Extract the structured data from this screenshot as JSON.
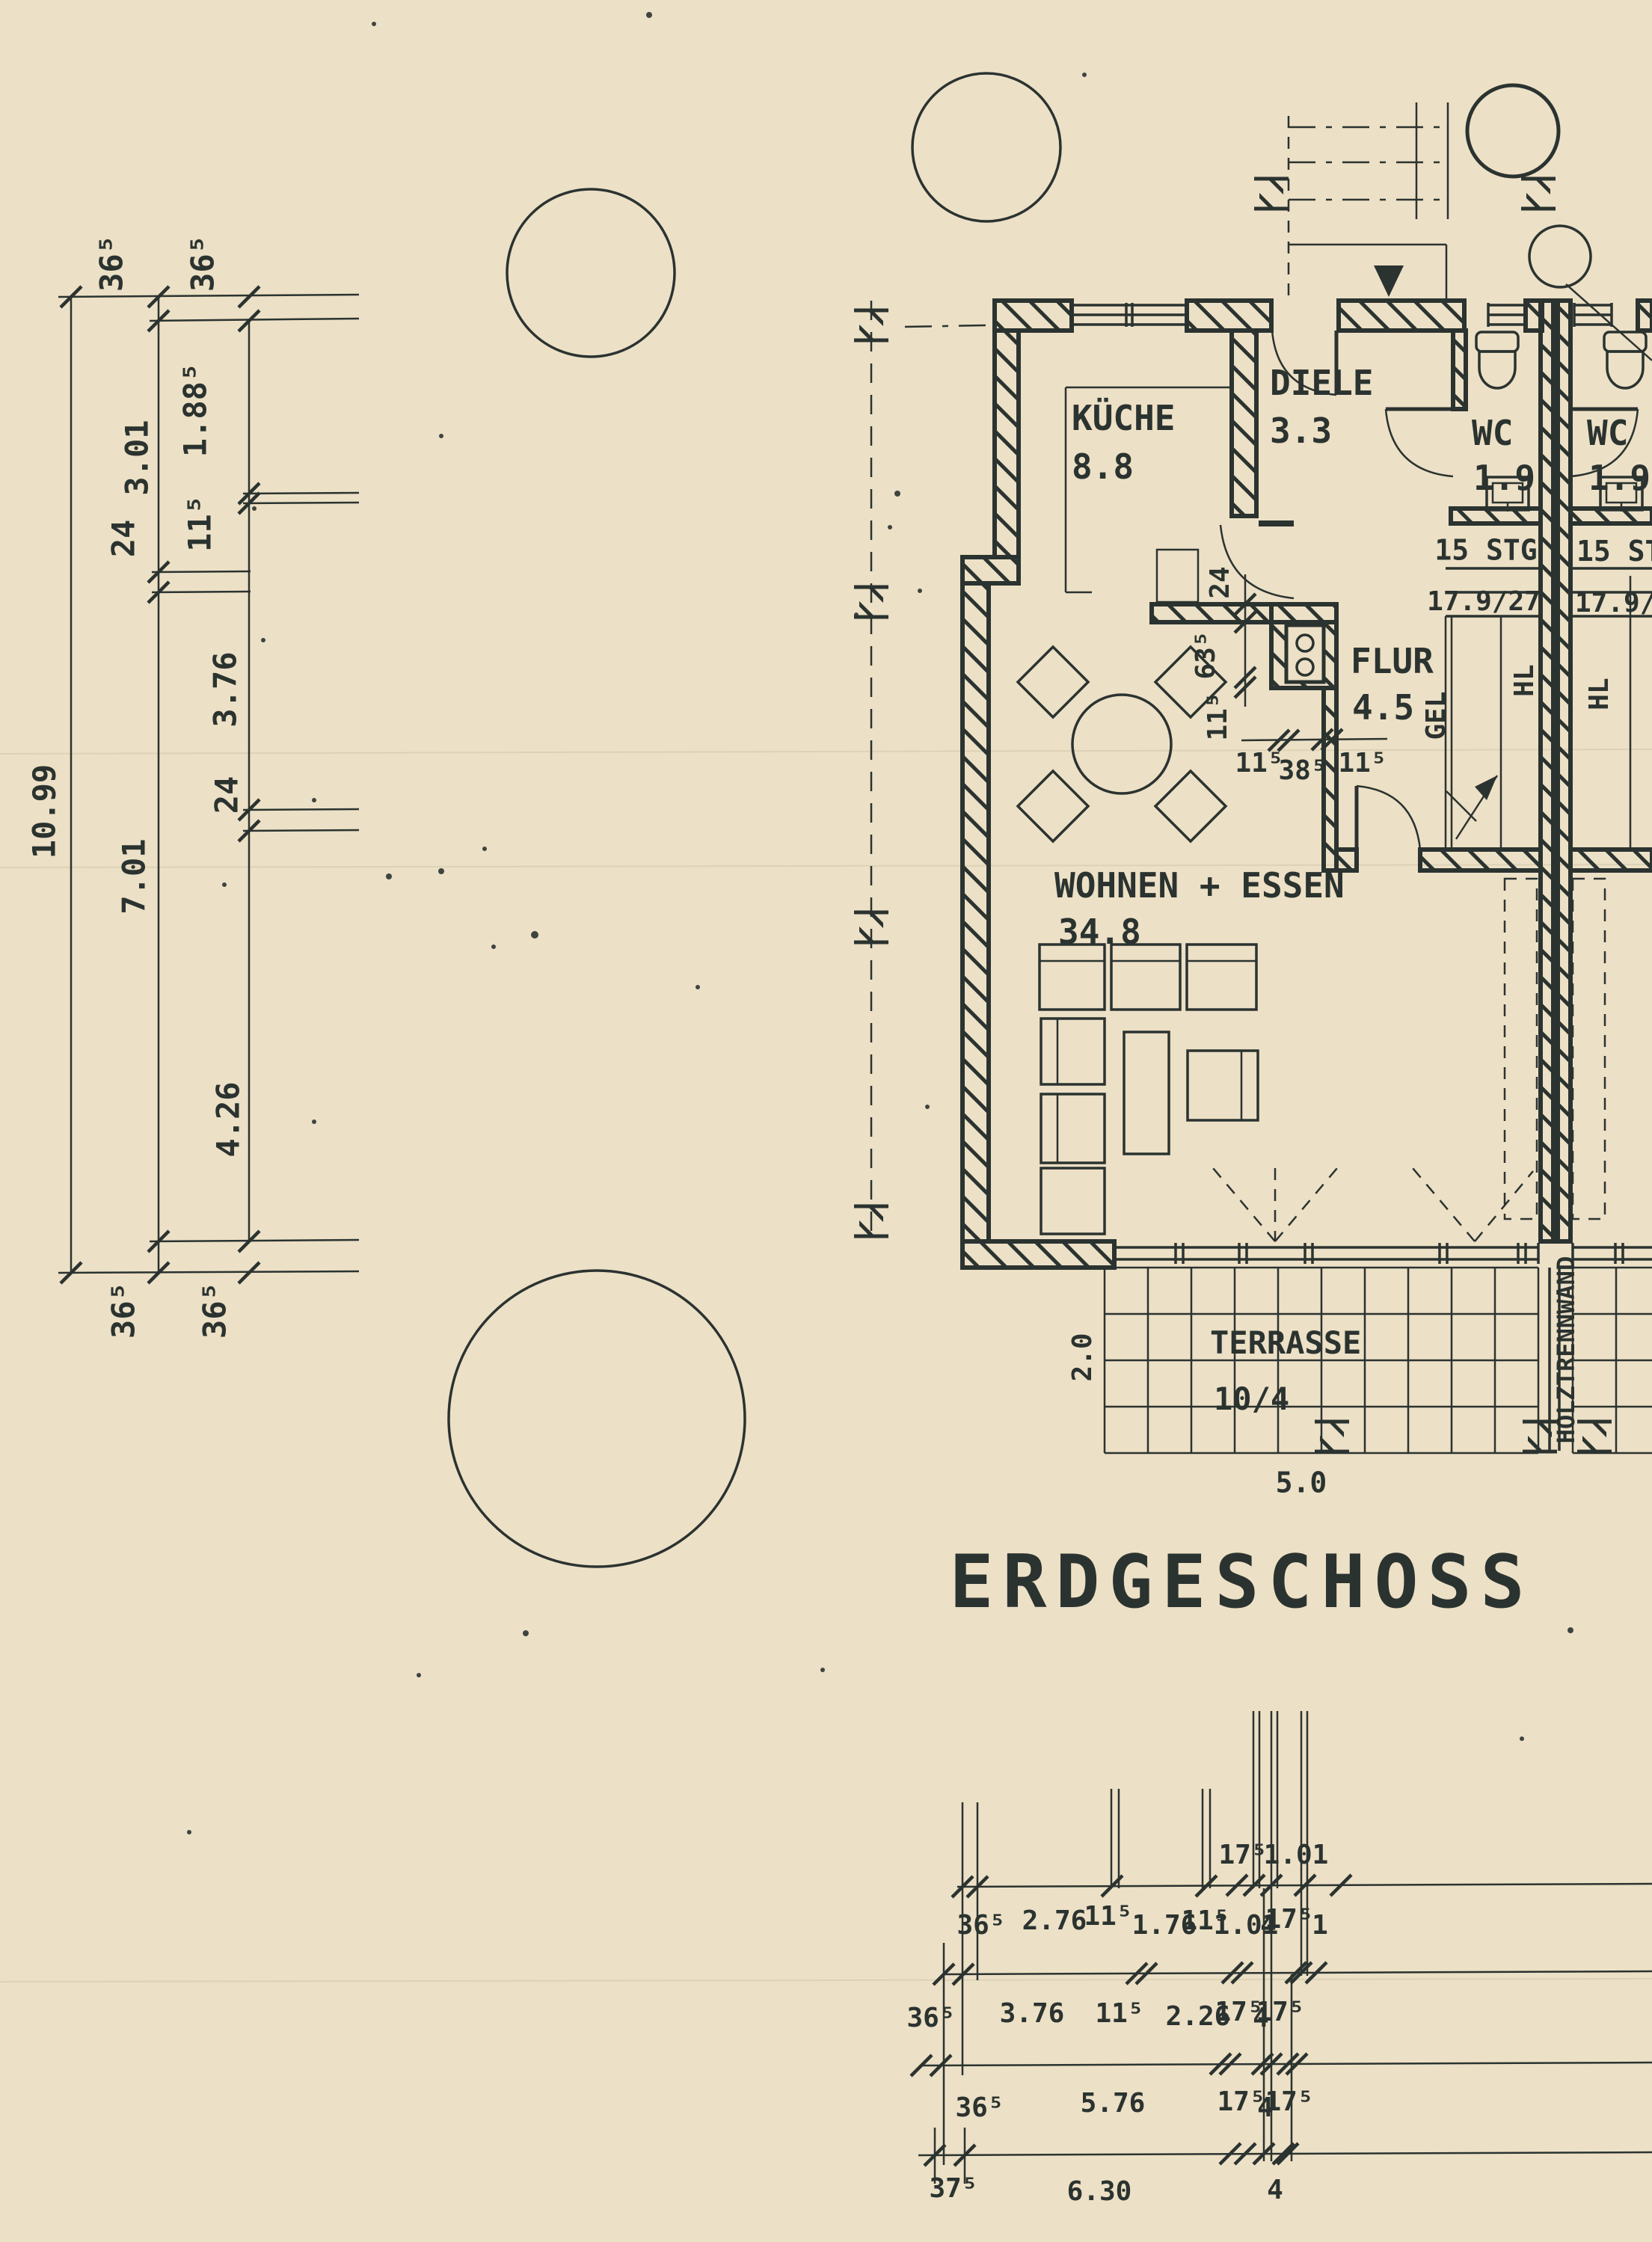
{
  "colors": {
    "paper": "#ece0c6",
    "ink": "#2b3330"
  },
  "title": "ERDGESCHOSS",
  "rooms": {
    "kueche": {
      "name": "KÜCHE",
      "area": "8.8"
    },
    "diele": {
      "name": "DIELE",
      "area": "3.3"
    },
    "wc_left": {
      "name": "WC",
      "area": "1.9"
    },
    "wc_right": {
      "name": "WC",
      "area": "1.9"
    },
    "flur": {
      "name": "FLUR",
      "area": "4.5"
    },
    "wohnen": {
      "name": "WOHNEN + ESSEN",
      "area": "34.8"
    },
    "terrasse": {
      "name": "TERRASSE",
      "area": "10/4"
    }
  },
  "stairs": {
    "left": {
      "steps": "15 STG",
      "ratio": "17.9/27"
    },
    "right": {
      "steps": "15 STG",
      "ratio": "17.9/27"
    }
  },
  "annotations": {
    "gel": "GEL",
    "hl_left": "HL",
    "hl_right": "HL",
    "holztrennwand": "HOLZTRENNWAND"
  },
  "dims": {
    "left_chain": {
      "total": "10.99",
      "b_top": "36⁵",
      "b_1": "3.01",
      "b_2": "24",
      "b_3": "7.01",
      "b_bottom": "36⁵",
      "c_top": "36⁵",
      "c_1": "1.88⁵",
      "c_2": "11⁵",
      "c_3": "3.76",
      "c_4": "24",
      "c_5": "4.26",
      "c_bottom": "36⁵"
    },
    "plan": {
      "wall": "24",
      "shaft_h": "63⁵",
      "shaft_h2": "11⁵",
      "w1": "11⁵",
      "w2": "38⁵",
      "w3": "11⁵"
    },
    "terrace": {
      "depth": "2.0",
      "width": "5.0"
    },
    "bottom_rows": {
      "r0": [
        "17⁵",
        "1.01"
      ],
      "r1": [
        "36⁵",
        "2.76",
        "11⁵",
        "1.76",
        "11⁵",
        "1.01",
        "4",
        "17⁵",
        "1"
      ],
      "r2": [
        "36⁵",
        "3.76",
        "11⁵",
        "2.26",
        "17⁵",
        "4",
        "17⁵"
      ],
      "r3": [
        "36⁵",
        "5.76",
        "17⁵",
        "4",
        "17⁵"
      ],
      "r4": [
        "37⁵",
        "6.30",
        "4"
      ]
    }
  }
}
